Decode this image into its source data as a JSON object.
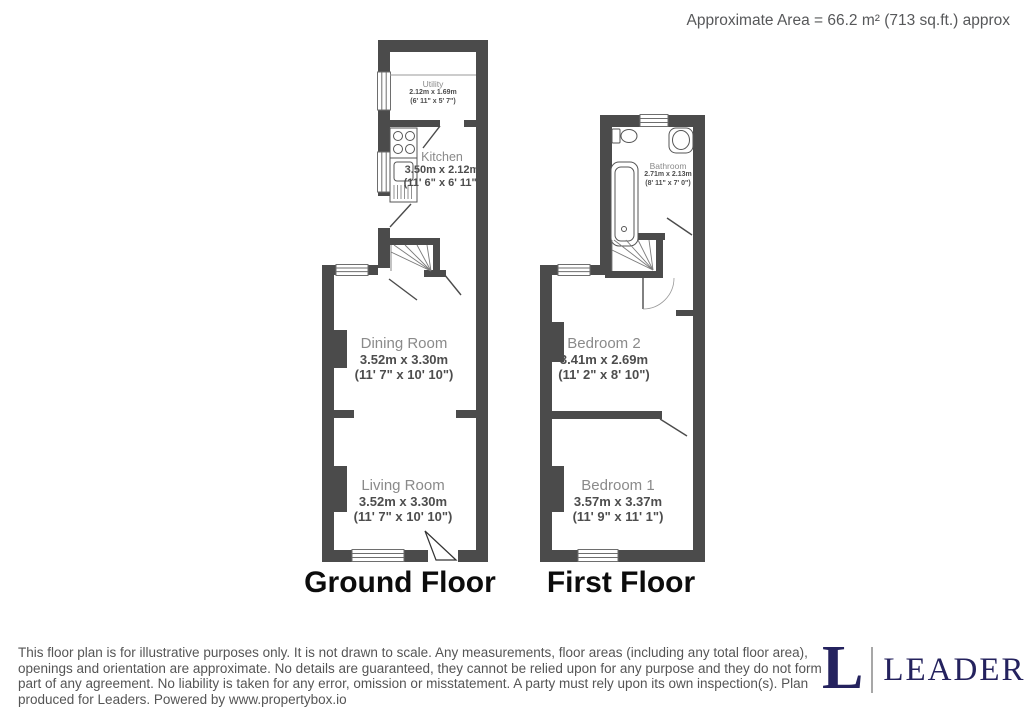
{
  "header": {
    "approximate_area": "Approximate Area = 66.2 m² (713 sq.ft.) approx"
  },
  "ground_floor": {
    "title": "Ground Floor",
    "rooms": {
      "utility": {
        "name": "Utility",
        "metric": "2.12m x 1.69m",
        "imperial": "(6' 11\" x 5' 7\")"
      },
      "kitchen": {
        "name": "Kitchen",
        "metric": "3.50m x 2.12m",
        "imperial": "(11' 6\" x 6' 11\")"
      },
      "dining_room": {
        "name": "Dining Room",
        "metric": "3.52m x 3.30m",
        "imperial": "(11' 7\" x 10' 10\")"
      },
      "living_room": {
        "name": "Living Room",
        "metric": "3.52m x 3.30m",
        "imperial": "(11' 7\" x 10' 10\")"
      }
    },
    "fixtures": [
      "hob",
      "sink-drainer",
      "staircase",
      "windows",
      "door-swings",
      "chimney-breasts"
    ]
  },
  "first_floor": {
    "title": "First Floor",
    "rooms": {
      "bathroom": {
        "name": "Bathroom",
        "metric": "2.71m x 2.13m",
        "imperial": "(8' 11\" x 7' 0\")"
      },
      "bedroom_2": {
        "name": "Bedroom 2",
        "metric": "3.41m x 2.69m",
        "imperial": "(11' 2\" x 8' 10\")"
      },
      "bedroom_1": {
        "name": "Bedroom 1",
        "metric": "3.57m x 3.37m",
        "imperial": "(11' 9\" x 11' 1\")"
      }
    },
    "fixtures": [
      "bathtub",
      "toilet",
      "basin",
      "staircase",
      "windows",
      "door-swings",
      "chimney-breasts"
    ]
  },
  "footer": {
    "disclaimer": "This floor plan is for illustrative purposes only. It is not drawn to scale. Any measurements, floor areas (including any total floor area), openings and orientation are approximate. No details are guaranteed, they cannot be relied upon for any purpose and they do not form part of any agreement. No liability is taken for any error, omission or misstatement. A party must rely upon its own inspection(s). Plan produced for Leaders. Powered by www.propertybox.io",
    "logo": {
      "letter": "L",
      "brand": "LEADERS",
      "color": "#24225e"
    }
  },
  "colors": {
    "wall": "#4b4b4b",
    "room_name_text": "#8a8a8a",
    "dimension_text": "#4d4d4d",
    "floor_title_text": "#0c0c0c",
    "disclaimer_text": "#555555",
    "logo_navy": "#24225e"
  }
}
